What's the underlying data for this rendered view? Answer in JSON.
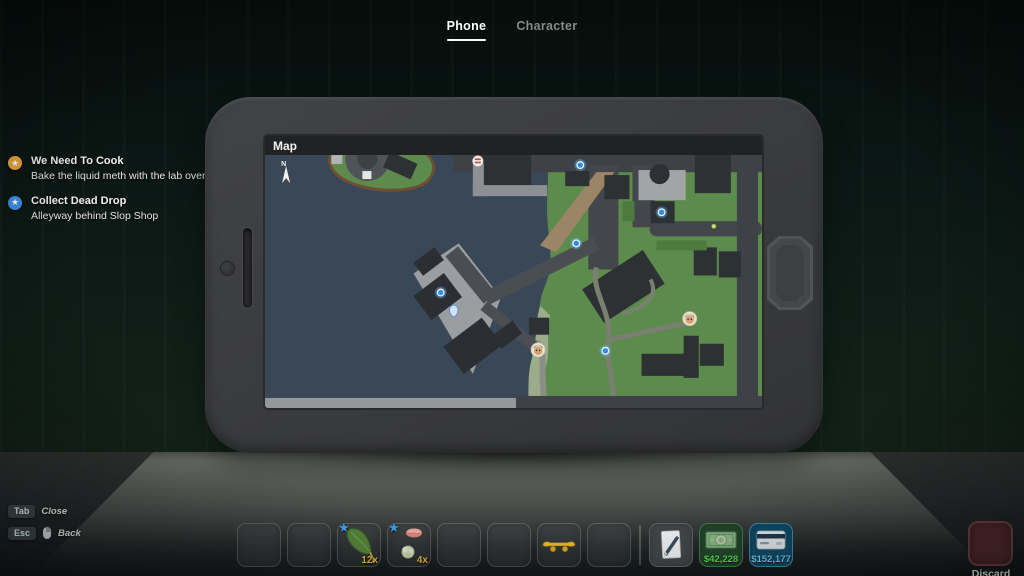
{
  "header_tabs": {
    "phone_label": "Phone",
    "character_label": "Character"
  },
  "quest_log": {
    "quests": [
      {
        "title": "We Need To Cook",
        "description": "Bake the liquid meth with the lab oven",
        "icon": "star",
        "icon_color": "#e9a53b"
      },
      {
        "title": "Collect Dead Drop",
        "description": "Alleyway behind Slop Shop",
        "icon": "star",
        "icon_color": "#3f8fe8"
      }
    ]
  },
  "phone_app": {
    "title": "Map",
    "compass_label": "N"
  },
  "map": {
    "water_color": "#3a4756",
    "land_color": "#5d8b4d",
    "markers": [
      {
        "type": "blue-objective",
        "x": 314,
        "y": 10
      },
      {
        "type": "shop",
        "x": 212,
        "y": 6
      },
      {
        "type": "blue-objective",
        "x": 395,
        "y": 57
      },
      {
        "type": "small-dot",
        "x": 447,
        "y": 71
      },
      {
        "type": "blue-objective",
        "x": 310,
        "y": 88
      },
      {
        "type": "blue-objective",
        "x": 175,
        "y": 137
      },
      {
        "type": "player",
        "x": 188,
        "y": 155
      },
      {
        "type": "npc-face",
        "x": 423,
        "y": 163
      },
      {
        "type": "npc-face",
        "x": 272,
        "y": 194
      },
      {
        "type": "blue-objective",
        "x": 339,
        "y": 195
      }
    ]
  },
  "hotkey_hints": [
    {
      "key": "Tab",
      "action": "Close"
    },
    {
      "key": "Esc",
      "action": "Back"
    }
  ],
  "hotbar": {
    "slots": [
      {
        "item": null
      },
      {
        "item": null
      },
      {
        "item": "leaf",
        "quantity": "12x",
        "starred": true
      },
      {
        "item": "product",
        "quantity": "4x",
        "starred": true
      },
      {
        "item": null
      },
      {
        "item": null
      },
      {
        "item": "skateboard"
      },
      {
        "item": null
      }
    ],
    "cash_value": "$42,228",
    "card_value": "$152,177",
    "cash_color": "#55e055",
    "card_color": "#6fd2f5",
    "discard_label": "Discard"
  }
}
